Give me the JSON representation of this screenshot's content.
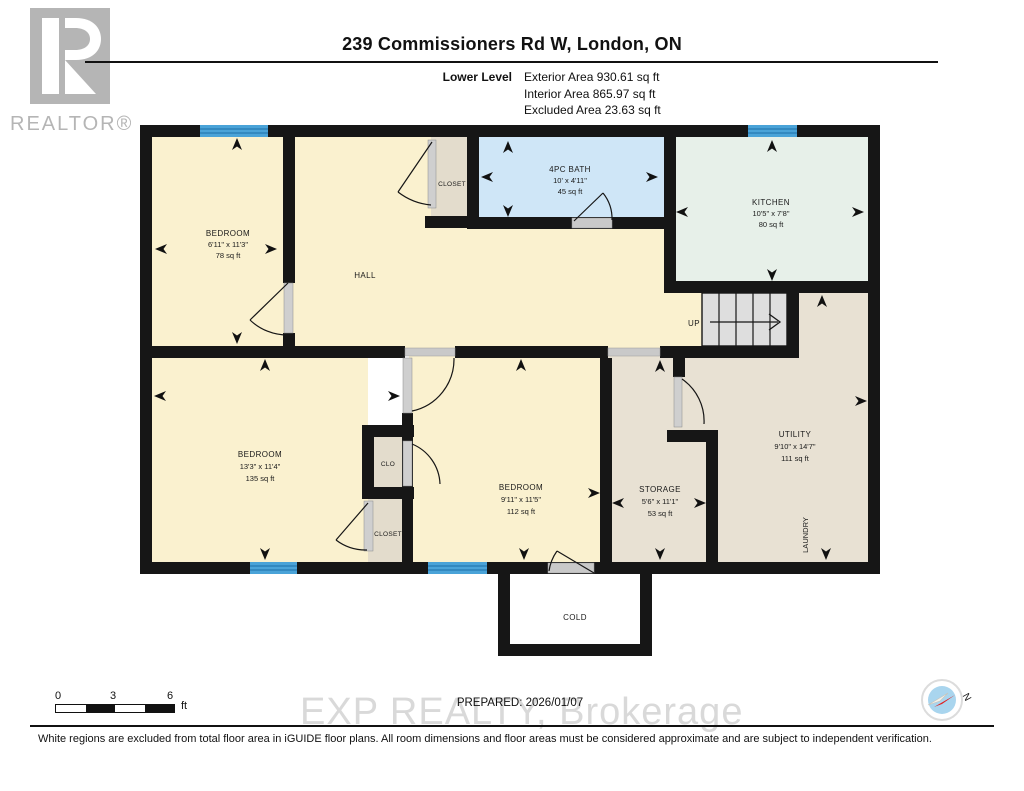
{
  "header": {
    "title": "239 Commissioners Rd W, London, ON",
    "level_label": "Lower Level",
    "exterior": "Exterior Area 930.61 sq ft",
    "interior": "Interior Area 865.97 sq ft",
    "excluded": "Excluded Area 23.63 sq ft"
  },
  "logo": {
    "letter": "R",
    "realtor": "REALTOR®"
  },
  "plan": {
    "rooms": {
      "bedroom1": {
        "name": "BEDROOM",
        "dims": "6'11\" x 11'3\"",
        "area": "78 sq ft"
      },
      "bath": {
        "name": "4PC BATH",
        "dims": "10' x 4'11\"",
        "area": "45 sq ft"
      },
      "kitchen": {
        "name": "KITCHEN",
        "dims": "10'5\" x 7'8\"",
        "area": "80 sq ft"
      },
      "bedroom2": {
        "name": "BEDROOM",
        "dims": "13'3\" x 11'4\"",
        "area": "135 sq ft"
      },
      "bedroom3": {
        "name": "BEDROOM",
        "dims": "9'11\" x 11'5\"",
        "area": "112 sq ft"
      },
      "storage": {
        "name": "STORAGE",
        "dims": "5'6\" x 11'1\"",
        "area": "53 sq ft"
      },
      "utility": {
        "name": "UTILITY",
        "dims": "9'10\" x 14'7\"",
        "area": "111 sq ft"
      }
    },
    "labels": {
      "hall": "HALL",
      "closet_top": "CLOSET",
      "clo": "CLO",
      "closet2": "CLOSET",
      "laundry": "LAUNDRY",
      "cold": "COLD",
      "up": "UP"
    }
  },
  "footer": {
    "scale": {
      "t0": "0",
      "t3": "3",
      "t6": "6",
      "unit": "ft"
    },
    "prepared": "PREPARED: 2026/01/07",
    "watermark": "EXP REALTY, Brokerage",
    "disclaimer": "White regions are excluded from total floor area in iGUIDE floor plans. All room dimensions and floor areas must be considered approximate and are subject to independent verification.",
    "compass_n": "N"
  },
  "colors": {
    "wall": "#161616",
    "bedroom": "#faf1cf",
    "bath": "#cfe6f7",
    "kitchen": "#e7f0e9",
    "utility": "#e8e1d3",
    "closet": "#e3dccc",
    "stairs": "#dedede",
    "window": "#4aa3d8",
    "cold": "#ffffff",
    "watermark": "#d9d9d9",
    "logo_gray": "#b5b5b5"
  }
}
